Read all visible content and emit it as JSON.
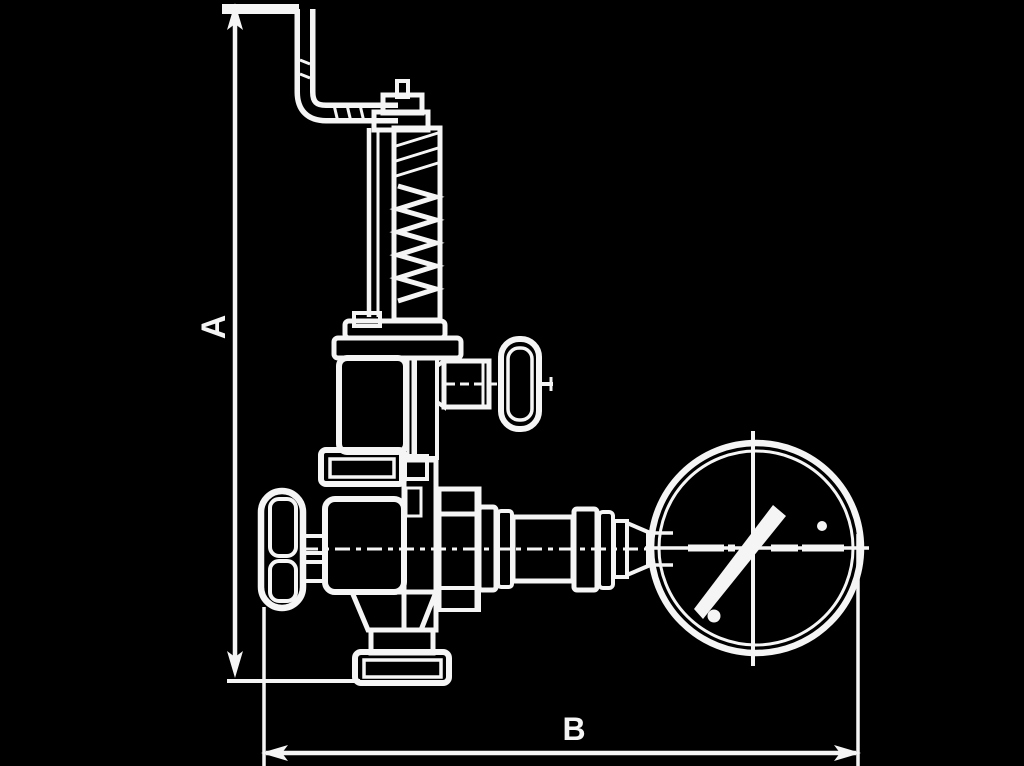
{
  "diagram": {
    "title": "valve-with-gauge-dimension-drawing",
    "dimension_labels": {
      "vertical": "A",
      "horizontal": "B"
    },
    "colors": {
      "background": "#000000",
      "line": "#f5f5f5"
    }
  }
}
